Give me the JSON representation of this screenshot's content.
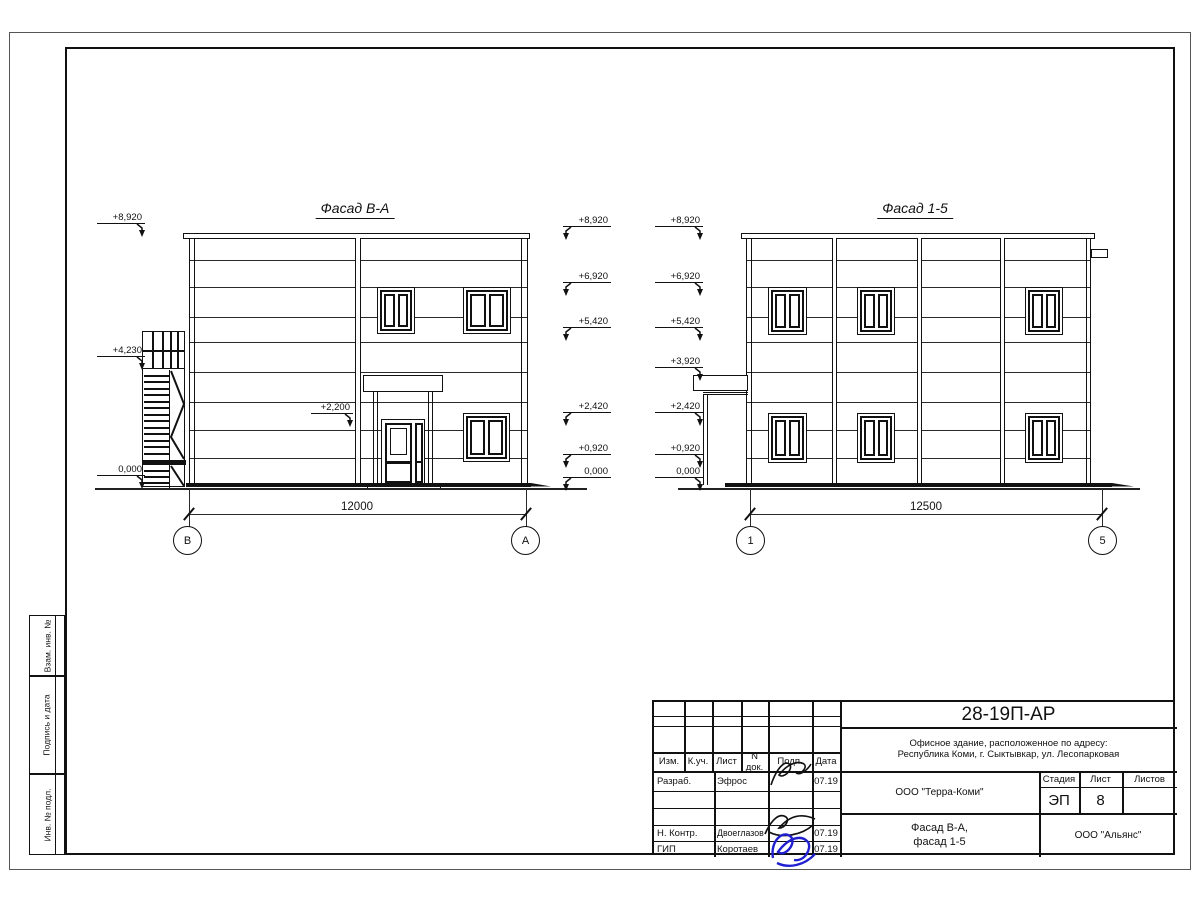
{
  "sheet": {
    "side_labels": [
      "Взам. инв. №",
      "Подпись и дата",
      "Инв. № подл."
    ]
  },
  "facade_ba": {
    "title": "Фасад В-А",
    "dimension": "12000",
    "axis_left": "В",
    "axis_right": "А",
    "marks_left": [
      "+8,920",
      "+4,230",
      "0,000"
    ],
    "marks_right": [
      "+8,920",
      "+6,920",
      "+5,420",
      "+2,420",
      "+0,920",
      "0,000"
    ],
    "canopy_mark": "+2,200"
  },
  "facade_15": {
    "title": "Фасад 1-5",
    "dimension": "12500",
    "axis_left": "1",
    "axis_right": "5",
    "marks_left": [
      "+8,920",
      "+6,920",
      "+5,420",
      "+3,920",
      "+2,420",
      "+0,920",
      "0,000"
    ]
  },
  "title_block": {
    "doc_number": "28-19П-АР",
    "address_line1": "Офисное здание, расположенное по адресу:",
    "address_line2": "Республика Коми, г. Сыктывкар, ул. Лесопарковая",
    "header": [
      "Изм.",
      "К.уч.",
      "Лист",
      "N док.",
      "Подп.",
      "Дата"
    ],
    "rows": [
      {
        "role": "Разраб.",
        "name": "Эфрос",
        "date": "07.19"
      },
      {
        "role": "Н. Контр.",
        "name": "Двоеглазов",
        "date": "07.19"
      },
      {
        "role": "ГИП",
        "name": "Коротаев",
        "date": "07.19"
      }
    ],
    "company": "ООО \"Терра-Коми\"",
    "stage_label": "Стадия",
    "sheet_label": "Лист",
    "sheets_label": "Листов",
    "stage": "ЭП",
    "sheet_no": "8",
    "drawing_title_line1": "Фасад В-А,",
    "drawing_title_line2": "фасад 1-5",
    "contractor": "ООО \"Альянс\"",
    "accent_signature_color": "#2020d0",
    "line_color": "#111111"
  }
}
